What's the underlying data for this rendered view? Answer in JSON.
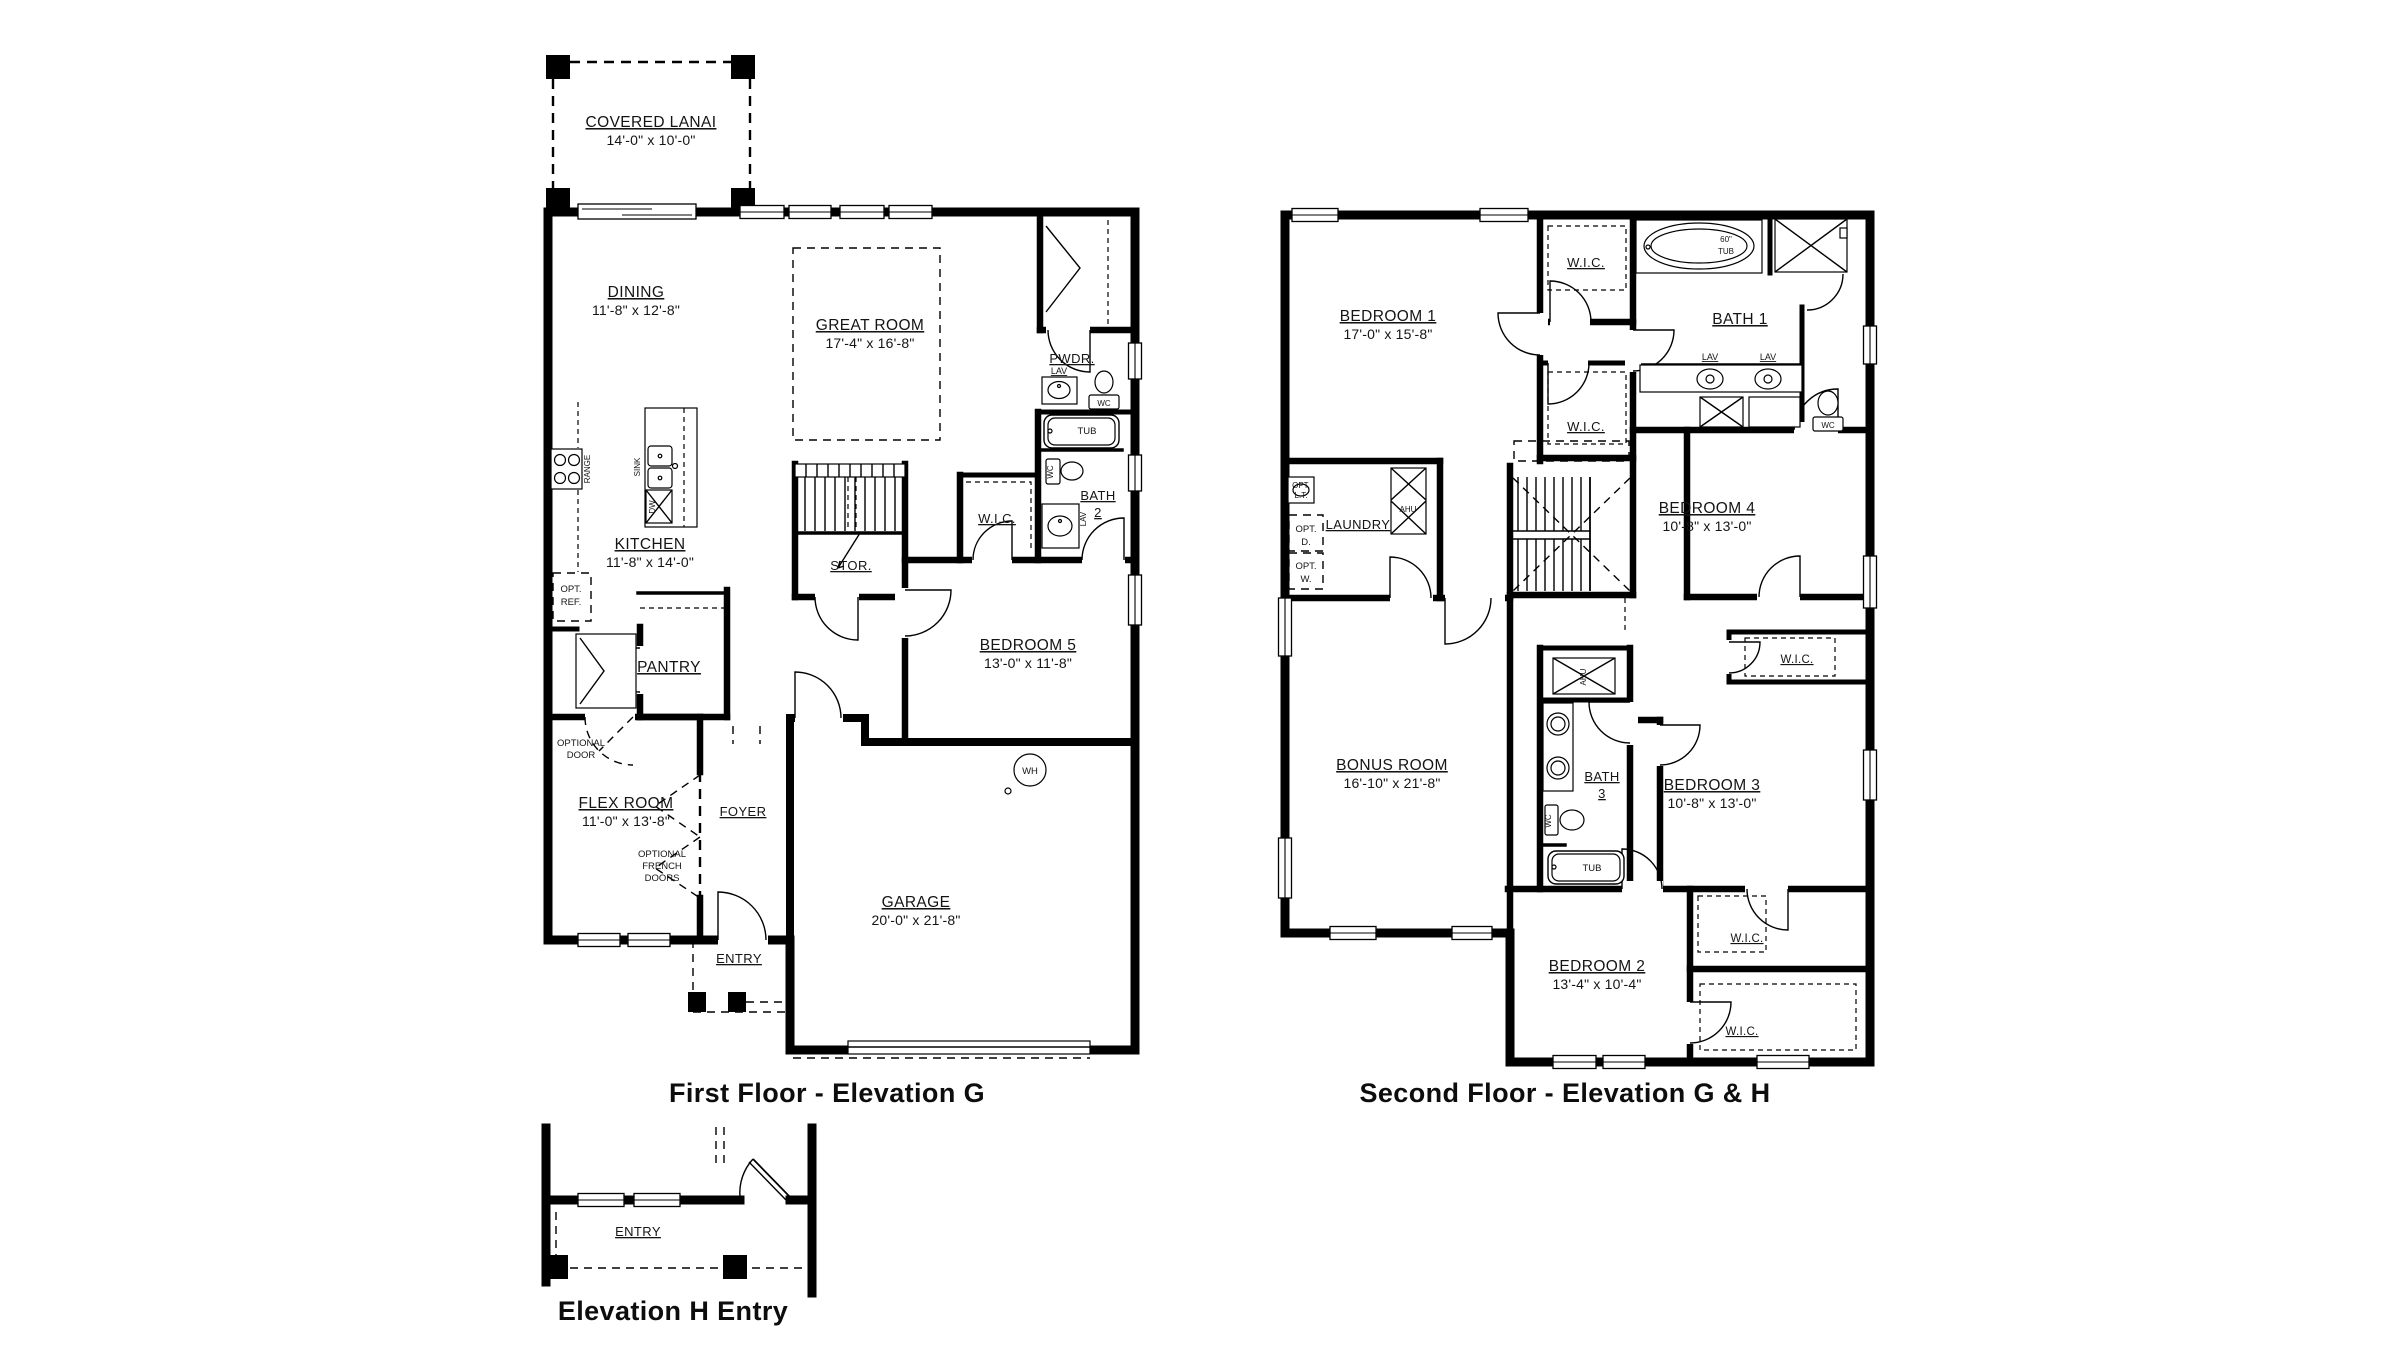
{
  "colors": {
    "ink": "#000000",
    "paper": "#ffffff"
  },
  "first_floor": {
    "title": "First Floor - Elevation G",
    "rooms": {
      "lanai": {
        "name": "COVERED LANAI",
        "dims": "14'-0\" x 10'-0\""
      },
      "dining": {
        "name": "DINING",
        "dims": "11'-8\" x 12'-8\""
      },
      "great_room": {
        "name": "GREAT ROOM",
        "dims": "17'-4\" x 16'-8\""
      },
      "kitchen": {
        "name": "KITCHEN",
        "dims": "11'-8\" x 14'-0\""
      },
      "pantry": {
        "name": "PANTRY"
      },
      "flex": {
        "name": "FLEX ROOM",
        "dims": "11'-0\" x 13'-8\""
      },
      "foyer": {
        "name": "FOYER"
      },
      "entry": {
        "name": "ENTRY"
      },
      "garage": {
        "name": "GARAGE",
        "dims": "20'-0\" x 21'-8\""
      },
      "bed5": {
        "name": "BEDROOM 5",
        "dims": "13'-0\" x 11'-8\""
      },
      "bath2": {
        "line1": "BATH",
        "line2": "2"
      },
      "wic": {
        "name": "W.I.C."
      },
      "stor": {
        "name": "STOR."
      },
      "pwdr": {
        "name": "PWDR."
      }
    },
    "fixtures": {
      "range": "RANGE",
      "sink": "SINK",
      "dw": "DW",
      "opt_ref_l1": "OPT.",
      "opt_ref_l2": "REF.",
      "lav": "LAV",
      "wc": "WC",
      "tub": "TUB",
      "wh": "WH",
      "optional_door_l1": "OPTIONAL",
      "optional_door_l2": "DOOR",
      "french_l1": "OPTIONAL",
      "french_l2": "FRENCH",
      "french_l3": "DOORS"
    }
  },
  "second_floor": {
    "title": "Second Floor - Elevation G & H",
    "rooms": {
      "bed1": {
        "name": "BEDROOM 1",
        "dims": "17'-0\" x 15'-8\""
      },
      "bath1": {
        "name": "BATH 1"
      },
      "wic": {
        "name": "W.I.C."
      },
      "laundry": {
        "name": "LAUNDRY"
      },
      "bed4": {
        "name": "BEDROOM 4",
        "dims": "10'-8\" x 13'-0\""
      },
      "bonus": {
        "name": "BONUS ROOM",
        "dims": "16'-10\" x 21'-8\""
      },
      "bath3": {
        "line1": "BATH",
        "line2": "3"
      },
      "bed3": {
        "name": "BEDROOM 3",
        "dims": "10'-8\" x 13'-0\""
      },
      "bed2": {
        "name": "BEDROOM 2",
        "dims": "13'-4\" x 10'-4\""
      }
    },
    "fixtures": {
      "tub60_l1": "60\"",
      "tub60_l2": "TUB",
      "lav": "LAV",
      "wc": "WC",
      "tub": "TUB",
      "ahu": "AHU",
      "opt_lt_l1": "OPT.",
      "opt_lt_l2": "L.T.",
      "opt_d_l1": "OPT.",
      "opt_d_l2": "D.",
      "opt_w_l1": "OPT.",
      "opt_w_l2": "W."
    }
  },
  "entry_detail": {
    "title": "Elevation H Entry",
    "rooms": {
      "entry": {
        "name": "ENTRY"
      }
    }
  }
}
